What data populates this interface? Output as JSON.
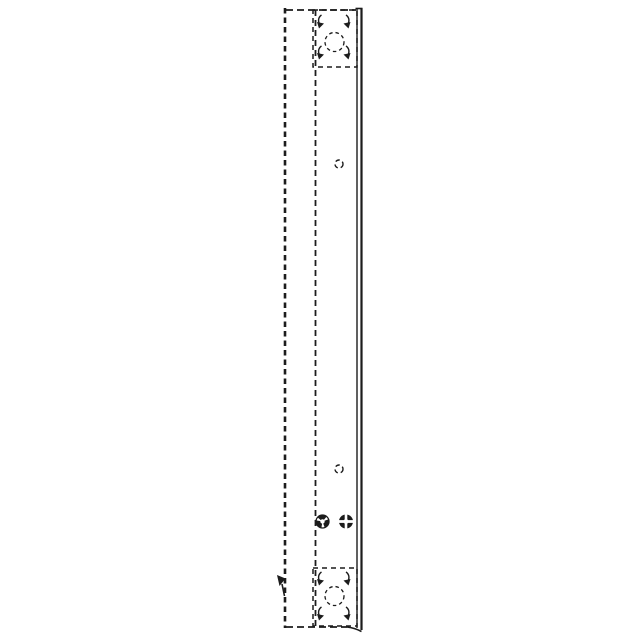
{
  "page": {
    "background": "#ffffff",
    "ink": "#1c1c1c",
    "description": "Technical line drawing of a tall narrow channel bracket, side elevation, hidden edges dashed"
  },
  "drawing": {
    "canvas": {
      "width": 640,
      "height": 640
    },
    "lines": [
      {
        "name": "left-hidden-edge",
        "x1": 285,
        "y1": 8,
        "x2": 285,
        "y2": 628,
        "width": 2.6,
        "dash": "5.5,4"
      },
      {
        "name": "inner-hidden-line",
        "x1": 315.5,
        "y1": 10,
        "x2": 315.5,
        "y2": 627,
        "width": 1.8,
        "dash": "6,4"
      },
      {
        "name": "right-edge-inner",
        "x1": 357,
        "y1": 9,
        "x2": 357,
        "y2": 628,
        "width": 1.4,
        "dash": "none"
      },
      {
        "name": "right-edge-outer",
        "x1": 361.5,
        "y1": 8,
        "x2": 361.5,
        "y2": 630,
        "width": 2.2,
        "dash": "none"
      },
      {
        "name": "top-edge",
        "x1": 286,
        "y1": 10,
        "x2": 356,
        "y2": 10,
        "width": 1.7,
        "dash": "7,4"
      },
      {
        "name": "top-cap",
        "x1": 355.5,
        "y1": 8.5,
        "x2": 362.5,
        "y2": 8.5,
        "width": 1.6,
        "dash": "none"
      },
      {
        "name": "bottom-edge",
        "x1": 286,
        "y1": 627,
        "x2": 347,
        "y2": 627,
        "width": 1.7,
        "dash": "7,4"
      }
    ],
    "curves": [
      {
        "name": "bottom-right-curve",
        "d": "M 347 627 Q 355 628 361.5 631.5",
        "width": 1.6
      }
    ],
    "pads": [
      {
        "name": "top-mount-pad",
        "x": 313,
        "y": 10,
        "w": 44,
        "h": 57,
        "dash": "5,4",
        "width": 1.5,
        "hole": {
          "cx": 334.5,
          "cy": 42,
          "r": 9.5,
          "dash": "3.5,3"
        }
      },
      {
        "name": "bottom-mount-pad",
        "x": 313,
        "y": 568,
        "w": 44,
        "h": 58,
        "dash": "5,4",
        "width": 1.5,
        "hole": {
          "cx": 334.5,
          "cy": 596,
          "r": 9.5,
          "dash": "3.5,3"
        }
      }
    ],
    "corner_marks": [
      {
        "x": 316.5,
        "y": 21,
        "side": "left"
      },
      {
        "x": 316.5,
        "y": 52,
        "side": "left"
      },
      {
        "x": 351,
        "y": 21,
        "side": "right"
      },
      {
        "x": 351,
        "y": 52,
        "side": "right"
      },
      {
        "x": 316.5,
        "y": 578,
        "side": "left"
      },
      {
        "x": 316.5,
        "y": 613,
        "side": "left"
      },
      {
        "x": 351,
        "y": 578,
        "side": "right"
      },
      {
        "x": 351,
        "y": 613,
        "side": "right"
      }
    ],
    "small_holes": [
      {
        "name": "pilot-hole-upper",
        "cx": 339,
        "cy": 164,
        "r": 4
      },
      {
        "name": "pilot-hole-lower",
        "cx": 339,
        "cy": 469,
        "r": 4
      }
    ],
    "fasteners": [
      {
        "name": "clip-fastener-symbol",
        "type": "pinwheel",
        "cx": 322.5,
        "cy": 521.5,
        "r": 6.5
      },
      {
        "name": "clinch-fastener-symbol",
        "type": "lobes",
        "cx": 346,
        "cy": 521.5,
        "r": 7
      }
    ],
    "arrow_mark": {
      "name": "leader-arrow",
      "x": 281,
      "y": 580
    }
  }
}
